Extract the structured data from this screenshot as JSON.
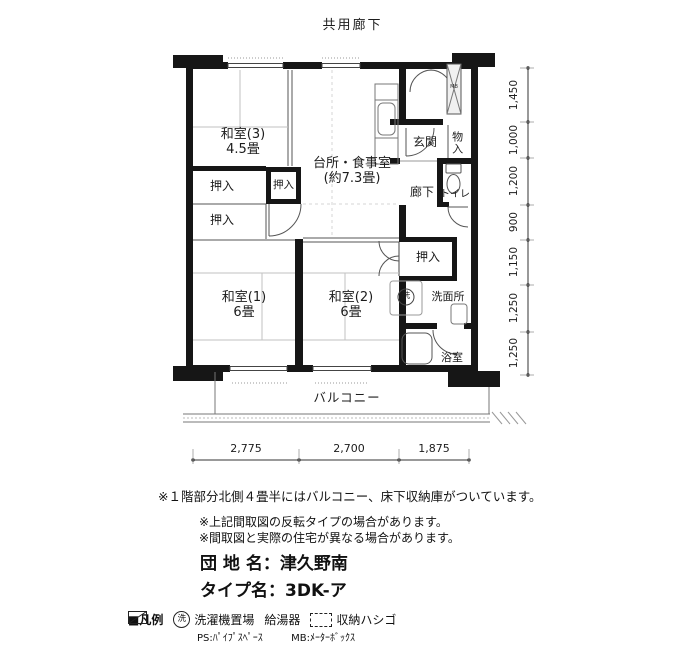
{
  "header": {
    "corridor": "共用廊下"
  },
  "plan": {
    "rooms": {
      "washitsu3_name": "和室(3)",
      "washitsu3_size": "4.5畳",
      "kitchen_name": "台所・食事室",
      "kitchen_size": "(約7.3畳)",
      "genkan": "玄関",
      "monoire": "物入",
      "rouka": "廊下",
      "toilet": "トイレ",
      "oshiire_a": "押入",
      "oshiire_b": "押入",
      "oshiire_c": "押入",
      "oshiire_d": "押入",
      "washitsu1_name": "和室(1)",
      "washitsu1_size": "6畳",
      "washitsu2_name": "和室(2)",
      "washitsu2_size": "6畳",
      "senmenjo": "洗面所",
      "yokushitsu": "浴室",
      "balcony": "バルコニー",
      "washer_mark": "洗",
      "mb_mark": "MB"
    },
    "dims_right": [
      "1,450",
      "1,000",
      "1,200",
      "900",
      "1,150",
      "1,250",
      "1,250"
    ],
    "dims_bottom": [
      "2,775",
      "2,700",
      "1,875"
    ]
  },
  "notes": {
    "line1": "※１階部分北側４畳半にはバルコニー、床下収納庫がついています。",
    "line2": "※上記間取図の反転タイプの場合があります。",
    "line3": "※間取図と実際の住宅が異なる場合があります。"
  },
  "property": {
    "estate_label": "団 地 名：",
    "estate_name": "津久野南",
    "type_label": "タイプ名：",
    "type_name": "3DK-ア"
  },
  "legend": {
    "title": "■凡例",
    "washer_symbol": "洗",
    "washer": "洗濯機置場",
    "heater": "給湯器",
    "ladder": "収納ハシゴ",
    "ps": "PS:ﾊﾟｲﾌﾟｽﾍﾟｰｽ",
    "mb": "MB:ﾒｰﾀｰﾎﾞｯｸｽ"
  },
  "colors": {
    "wall": "#161616",
    "line": "#555555",
    "bg": "#ffffff"
  }
}
